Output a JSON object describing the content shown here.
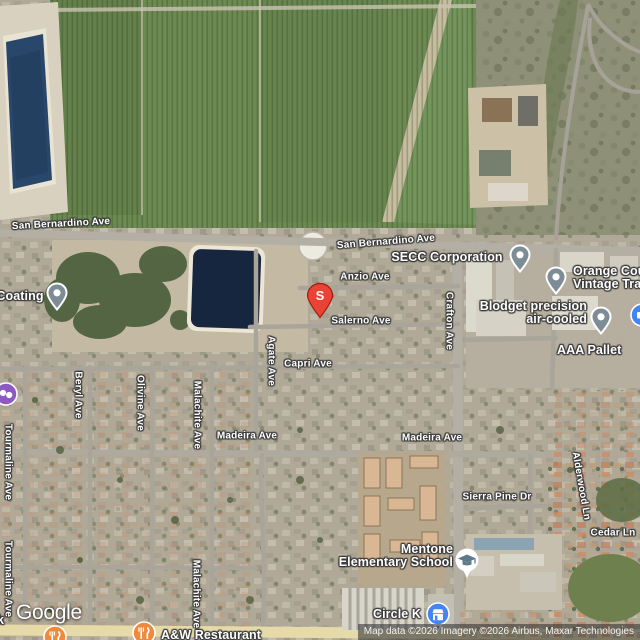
{
  "logo": {
    "text": "Google"
  },
  "attribution": {
    "text": "Map data ©2026 Imagery ©2026 Airbus, Maxar Technologies"
  },
  "marker": {
    "label": "S",
    "color": "#EA4335"
  },
  "streets": [
    {
      "label": "San Bernardino Ave"
    },
    {
      "label": "San Bernardino Ave"
    },
    {
      "label": "Anzio Ave"
    },
    {
      "label": "Salerno Ave"
    },
    {
      "label": "Capri Ave"
    },
    {
      "label": "Madeira Ave"
    },
    {
      "label": "Madeira Ave"
    },
    {
      "label": "Sierra Pine Dr"
    },
    {
      "label": "Cedar Ln"
    },
    {
      "label": "Crafton Ave"
    },
    {
      "label": "Agate Ave"
    },
    {
      "label": "Beryl Ave"
    },
    {
      "label": "Olivine Ave"
    },
    {
      "label": "Malachite Ave"
    },
    {
      "label": "Malachite Ave"
    },
    {
      "label": "Tourmaline Ave"
    },
    {
      "label": "Tourmaline Ave"
    },
    {
      "label": "Alderwood Ln"
    }
  ],
  "pois": [
    {
      "lines": [
        "Coating"
      ]
    },
    {
      "lines": [
        "SECC Corporation"
      ]
    },
    {
      "lines": [
        "Orange Cou",
        "Vintage Tra"
      ]
    },
    {
      "lines": [
        "Blodget precision",
        "air-cooled"
      ]
    },
    {
      "lines": [
        "AAA Pallet"
      ]
    },
    {
      "lines": [
        "Mentone",
        "Elementary School"
      ]
    },
    {
      "lines": [
        "Circle K"
      ]
    },
    {
      "lines": [
        "A&W Restaurant"
      ]
    },
    {
      "lines": [
        "k"
      ]
    }
  ],
  "colors": {
    "generic_pin": "#7E8C96",
    "marker_red": "#EA4335",
    "school_icon": "#5C7A8A",
    "convenience_store_icon": "#4285F4",
    "restaurant_icon": "#EF8A3D",
    "attraction_icon": "#8E59C3",
    "edge_poi_icon": "#4285F4"
  }
}
